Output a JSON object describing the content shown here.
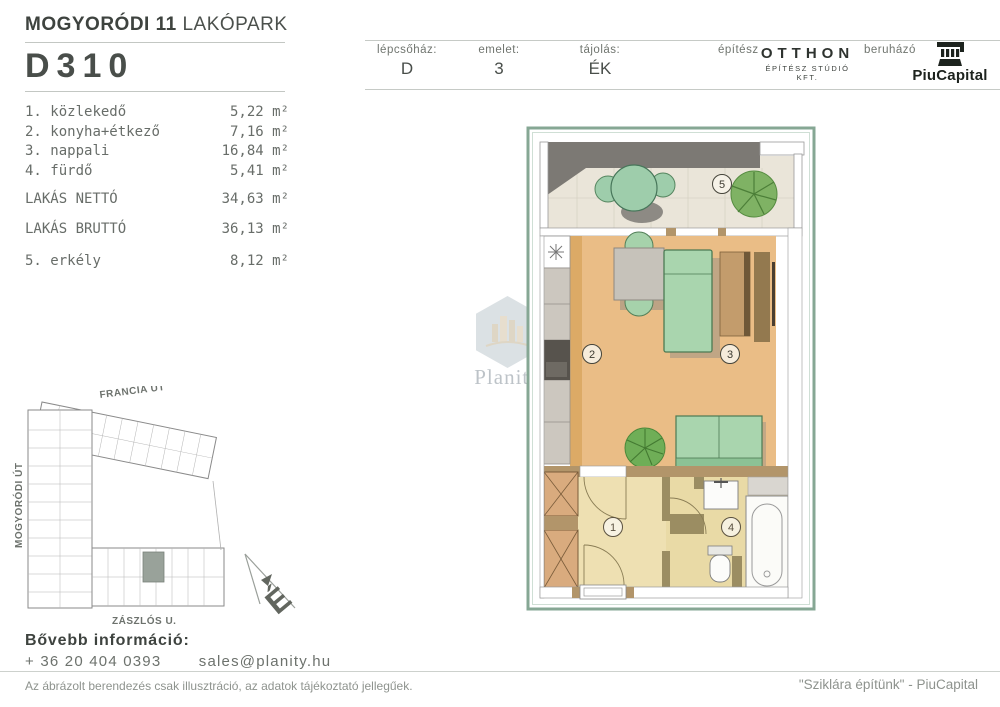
{
  "header": {
    "project_bold": "MOGYORÓDI 11",
    "project_light": "LAKÓPARK",
    "unit_id": "D310",
    "info": {
      "staircase_label": "lépcsőház:",
      "staircase_value": "D",
      "floor_label": "emelet:",
      "floor_value": "3",
      "orientation_label": "tájolás:",
      "orientation_value": "ÉK",
      "architect_label": "építész",
      "architect_name": "OTTHON",
      "architect_sub": "ÉPÍTÉSZ STÚDIÓ KFT.",
      "developer_label": "beruházó",
      "developer_name": "PiuCapital"
    }
  },
  "rooms": {
    "items": [
      {
        "num": "1.",
        "name": "közlekedő",
        "area": "5,22 m²"
      },
      {
        "num": "2.",
        "name": "konyha+étkező",
        "area": "7,16 m²"
      },
      {
        "num": "3.",
        "name": "nappali",
        "area": "16,84 m²"
      },
      {
        "num": "4.",
        "name": "fürdő",
        "area": "5,41 m²"
      }
    ],
    "net_label": "LAKÁS NETTÓ",
    "net_area": "34,63 m²",
    "gross_label": "LAKÁS BRUTTÓ",
    "gross_area": "36,13 m²",
    "balcony_num": "5.",
    "balcony_name": "erkély",
    "balcony_area": "8,12 m²"
  },
  "floorplan": {
    "labels": {
      "hall": "1",
      "kitchen": "2",
      "living": "3",
      "bath": "4",
      "balcony": "5"
    }
  },
  "siteplan": {
    "street_top": "FRANCIA ÚT",
    "street_left": "MOGYORÓDI ÚT",
    "street_bottom": "ZÁSZLÓS U.",
    "north_letter": "É"
  },
  "watermark": {
    "text": "Planity"
  },
  "contact": {
    "heading": "Bővebb információ:",
    "phone": "+ 36 20 404 0393",
    "email": "sales@planity.hu"
  },
  "footer": {
    "disclaimer": "Az ábrázolt berendezés csak illusztráció, az adatok tájékoztató jellegűek.",
    "slogan": "\"Sziklára építünk\" - PiuCapital"
  },
  "colors": {
    "accent_green_frame": "#86a794",
    "wood_floor": "#eabd86",
    "hall_floor": "#eee0b2",
    "wall_brown": "#b2956a",
    "furniture_green": "#a9d5ae",
    "dark_band": "#7c7974"
  }
}
